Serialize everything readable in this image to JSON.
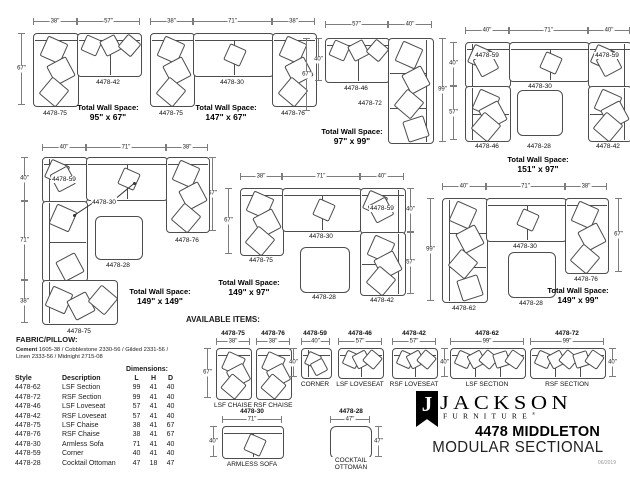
{
  "brand": {
    "logo_initial": "J",
    "name": "JACKSON",
    "wordmark": "FURNITURE",
    "registered": "®",
    "collection": "4478 MIDDLETON",
    "product_type": "MODULAR SECTIONAL",
    "date_code": "06/2019"
  },
  "fabric": {
    "heading": "FABRIC/PILLOW:",
    "line1_lead": "Cement",
    "line1_rest": " 1605-38 / Cobblestone 2330-56 / Gilded 2331-56 /",
    "line2": "Linen 2333-56 / Midnight 2715-08"
  },
  "spec_table": {
    "dims_header": "Dimensions:",
    "columns": [
      "Style",
      "Description",
      "L",
      "H",
      "D"
    ],
    "rows": [
      [
        "4478-62",
        "LSF Section",
        "99",
        "41",
        "40"
      ],
      [
        "4478-72",
        "RSF Section",
        "99",
        "41",
        "40"
      ],
      [
        "4478-46",
        "LSF Loveseat",
        "57",
        "41",
        "40"
      ],
      [
        "4478-42",
        "RSF Loveseat",
        "57",
        "41",
        "40"
      ],
      [
        "4478-75",
        "LSF Chaise",
        "38",
        "41",
        "67"
      ],
      [
        "4478-76",
        "RSF Chaise",
        "38",
        "41",
        "67"
      ],
      [
        "4478-30",
        "Armless Sofa",
        "71",
        "41",
        "40"
      ],
      [
        "4478-59",
        "Corner",
        "40",
        "41",
        "40"
      ],
      [
        "4478-28",
        "Cocktail Ottoman",
        "47",
        "18",
        "47"
      ]
    ]
  },
  "available": {
    "heading": "AVAILABLE ITEMS:",
    "items": [
      {
        "style": "4478-75",
        "w": "38\"",
        "side": "67\"",
        "name": "LSF CHAISE"
      },
      {
        "style": "4478-76",
        "w": "38\"",
        "name": "RSF CHAISE"
      },
      {
        "style": "4478-59",
        "w": "40\"",
        "side": "40\"",
        "name": "CORNER"
      },
      {
        "style": "4478-46",
        "w": "57\"",
        "name": "LSF LOVESEAT"
      },
      {
        "style": "4478-42",
        "w": "57\"",
        "side": "40\"",
        "name": "RSF LOVESEAT"
      },
      {
        "style": "4478-62",
        "w": "99\"",
        "name": "LSF SECTION"
      },
      {
        "style": "4478-72",
        "w": "99\"",
        "side": "40\"",
        "name": "RSF SECTION"
      },
      {
        "style": "4478-30",
        "w": "71\"",
        "side": "40\"",
        "name": "ARMLESS SOFA"
      },
      {
        "style": "4478-28",
        "w": "47\"",
        "side": "47\"",
        "name": "COCKTAIL OTTOMAN"
      }
    ]
  },
  "configs": [
    {
      "total_label": "Total Wall Space:",
      "total_value": "95\" x 67\"",
      "dims": [
        "38\"",
        "57\"",
        "67\""
      ],
      "pieces": [
        "4478-75",
        "4478-42"
      ]
    },
    {
      "total_label": "Total Wall Space:",
      "total_value": "147\" x 67\"",
      "dims": [
        "38\"",
        "71\"",
        "38\""
      ],
      "pieces": [
        "4478-75",
        "4478-30",
        "4478-76"
      ]
    },
    {
      "total_label": "Total Wall Space:",
      "total_value": "97\" x 99\"",
      "dims": [
        "57\"",
        "40\"",
        "40\"",
        "67\"",
        "99\""
      ],
      "pieces": [
        "4478-46",
        "4478-72"
      ]
    },
    {
      "total_label": "Total Wall Space:",
      "total_value": "151\" x 97\"",
      "dims": [
        "40\"",
        "71\"",
        "40\"",
        "40\"",
        "57\"",
        "40\"",
        "57\""
      ],
      "pieces": [
        "4478-59",
        "4478-30",
        "4478-59",
        "4478-46",
        "4478-28",
        "4478-42"
      ]
    },
    {
      "total_label": "Total Wall Space:",
      "total_value": "149\" x 149\"",
      "dims": [
        "40\"",
        "71\"",
        "38\"",
        "40\"",
        "71\"",
        "38\"",
        "67\""
      ],
      "pieces": [
        "4478-59",
        "4478-76",
        "4478-75",
        "4478-28"
      ],
      "callout": "4478-30"
    },
    {
      "total_label": "Total Wall Space:",
      "total_value": "149\" x 97\"",
      "dims": [
        "38\"",
        "71\"",
        "40\"",
        "67\"",
        "40\"",
        "57\""
      ],
      "pieces": [
        "4478-75",
        "4478-30",
        "4478-59",
        "4478-42",
        "4478-28"
      ]
    },
    {
      "total_label": "Total Wall Space:",
      "total_value": "149\" x 99\"",
      "dims": [
        "40\"",
        "71\"",
        "38\"",
        "99\"",
        "67\""
      ],
      "pieces": [
        "4478-62",
        "4478-30",
        "4478-76",
        "4478-28"
      ]
    }
  ]
}
